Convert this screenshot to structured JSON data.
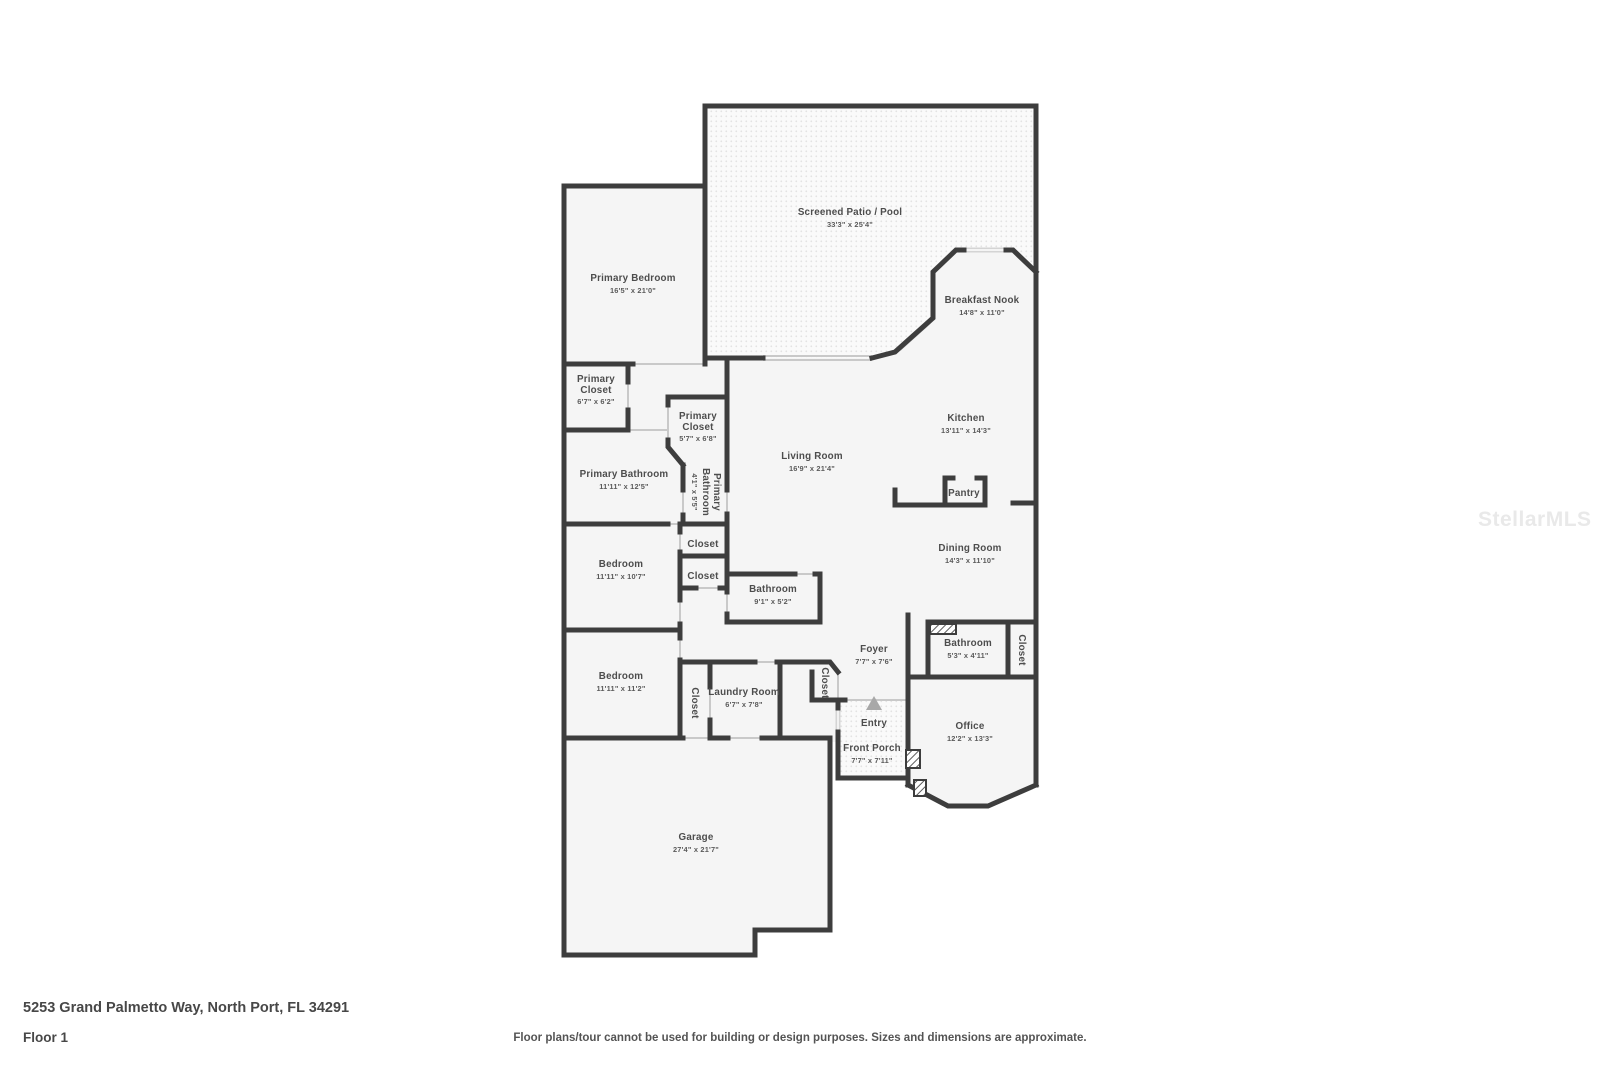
{
  "watermark": {
    "text": "StellarMLS",
    "color": "#e9e9e9"
  },
  "footer": {
    "address": "5253 Grand Palmetto Way, North Port, FL 34291",
    "floor_label": "Floor 1",
    "disclaimer": "Floor plans/tour cannot be used for building or design purposes. Sizes and dimensions are approximate."
  },
  "colors": {
    "wall": "#3d3d3d",
    "room_fill": "#f5f5f5",
    "window": "#d4d4d4",
    "screen_wall": "#dcdcdc",
    "label_text": "#4d4d4d"
  },
  "rooms": {
    "screened_patio": {
      "name": "Screened Patio / Pool",
      "dims": "33'3\" x 25'4\""
    },
    "primary_bedroom": {
      "name": "Primary Bedroom",
      "dims": "16'5\" x 21'0\""
    },
    "breakfast_nook": {
      "name": "Breakfast Nook",
      "dims": "14'8\" x 11'0\""
    },
    "primary_closet_a": {
      "name_line1": "Primary",
      "name_line2": "Closet",
      "dims": "6'7\" x 6'2\""
    },
    "primary_closet_b": {
      "name_line1": "Primary",
      "name_line2": "Closet",
      "dims": "5'7\" x 6'8\""
    },
    "primary_bathroom": {
      "name": "Primary Bathroom",
      "dims": "11'11\" x 12'5\""
    },
    "primary_bathroom_small": {
      "name_line1": "Primary",
      "name_line2": "Bathroom",
      "dims": "4'1\" x 5'5\""
    },
    "kitchen": {
      "name": "Kitchen",
      "dims": "13'11\" x 14'3\""
    },
    "living_room": {
      "name": "Living Room",
      "dims": "16'9\" x 21'4\""
    },
    "pantry": {
      "name": "Pantry"
    },
    "dining_room": {
      "name": "Dining Room",
      "dims": "14'3\" x 11'10\""
    },
    "closet_hall_a": {
      "name": "Closet"
    },
    "closet_hall_b": {
      "name": "Closet"
    },
    "bathroom_hall": {
      "name": "Bathroom",
      "dims": "9'1\" x 5'2\""
    },
    "bedroom_a": {
      "name": "Bedroom",
      "dims": "11'11\" x 10'7\""
    },
    "bedroom_b": {
      "name": "Bedroom",
      "dims": "11'11\" x 11'2\""
    },
    "closet_bedroom_b": {
      "name": "Closet"
    },
    "laundry_room": {
      "name": "Laundry Room",
      "dims": "6'7\" x 7'8\""
    },
    "closet_foyer": {
      "name": "Closet"
    },
    "foyer": {
      "name": "Foyer",
      "dims": "7'7\" x 7'6\""
    },
    "entry": {
      "name": "Entry"
    },
    "front_porch": {
      "name": "Front Porch",
      "dims": "7'7\" x 7'11\""
    },
    "bathroom_office": {
      "name": "Bathroom",
      "dims": "5'3\" x 4'11\""
    },
    "closet_office": {
      "name": "Closet"
    },
    "office": {
      "name": "Office",
      "dims": "12'2\" x 13'3\""
    },
    "garage": {
      "name": "Garage",
      "dims": "27'4\" x 21'7\""
    }
  }
}
